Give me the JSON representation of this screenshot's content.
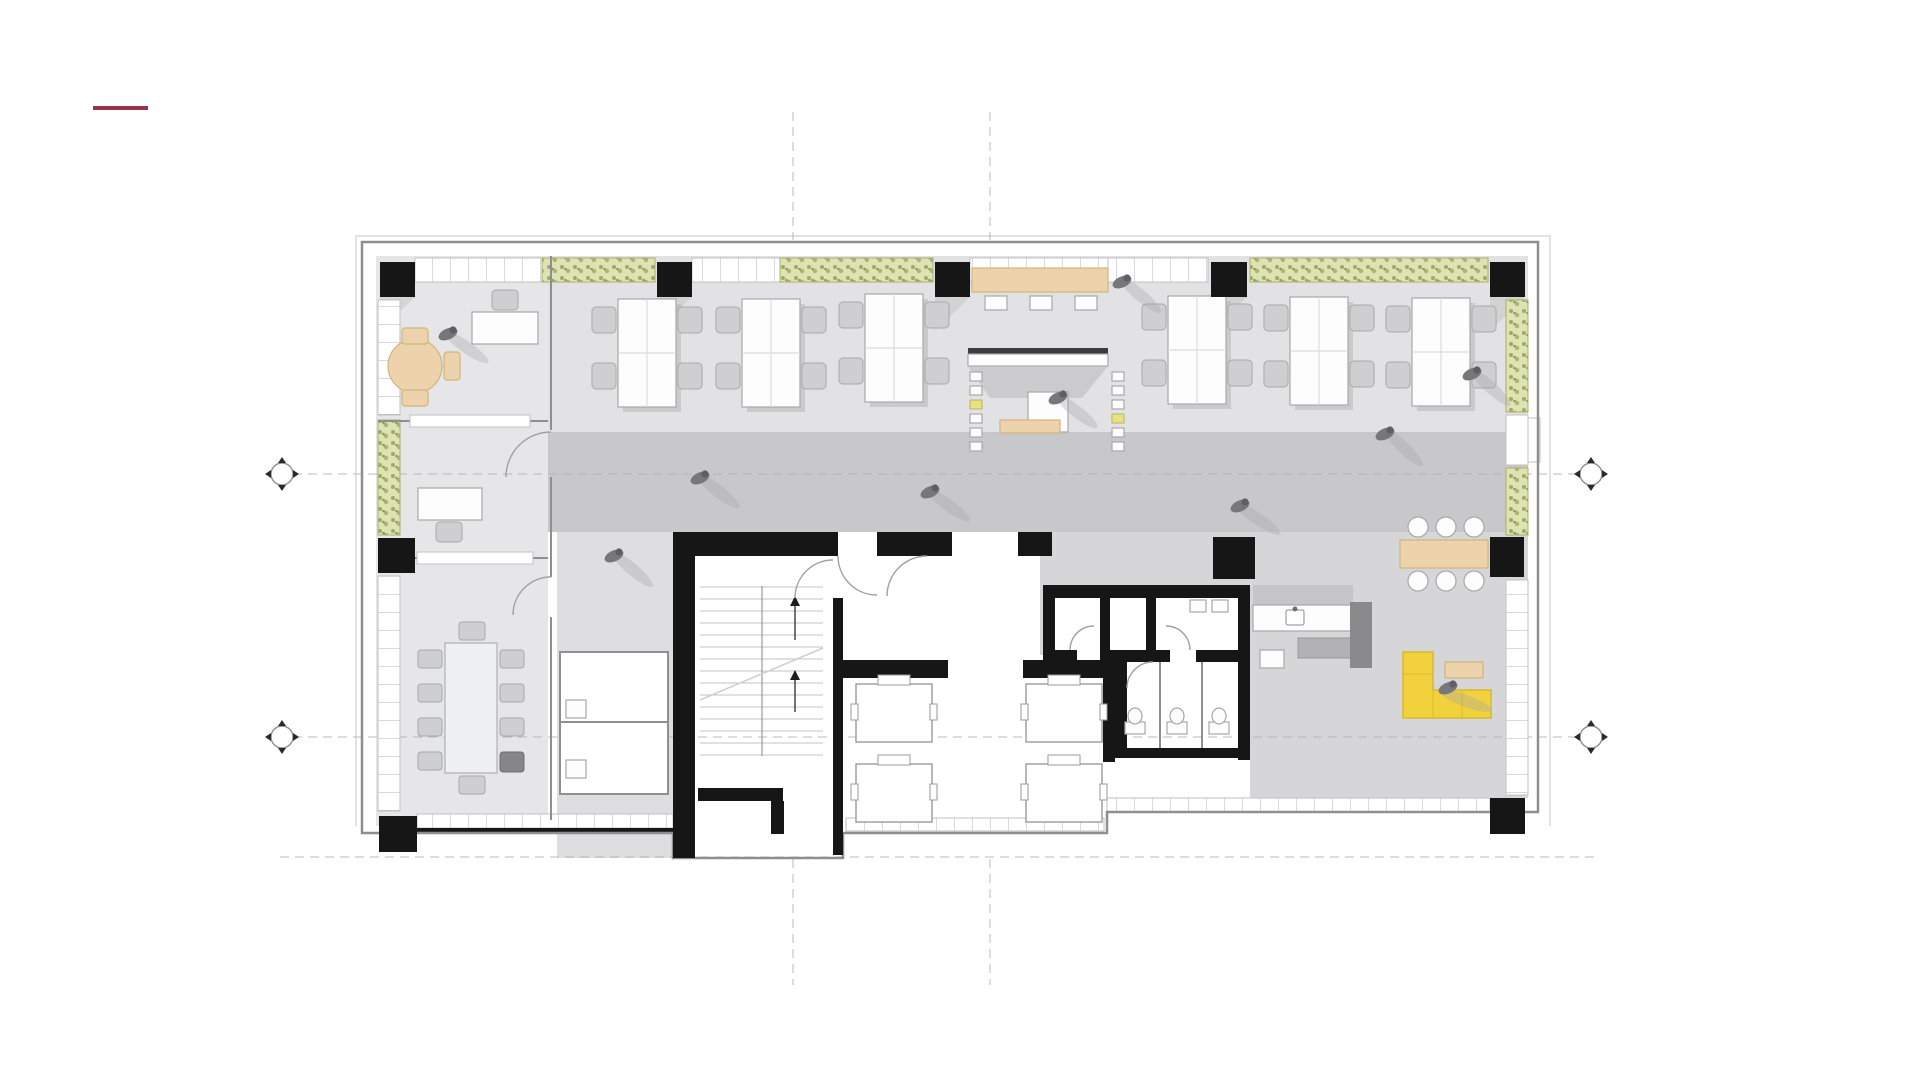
{
  "meta": {
    "label": "architectural-office-floor-plan-slide"
  },
  "accent_mark": {
    "color": "#993349",
    "x": 93,
    "y": 106,
    "width": 55,
    "height": 4
  },
  "palette": {
    "bg": "#ffffff",
    "floor": "#e2e2e4",
    "floor-office": "#e6e6e8",
    "floor-inner": "#dedee0",
    "corridor": "#c8c8cb",
    "lounge": "#d6d6d9",
    "wall": "#8f8f92",
    "wall-dark": "#161616",
    "window": "#ffffff",
    "mullion": "#c2c2c5",
    "planter": "#dde3b2",
    "planter-dot": "#8f9c52",
    "planter-edge": "#a8b06a",
    "wood": "#ecd3ab",
    "wood-edge": "#d3b37f",
    "sofa": "#f2d23c",
    "sofa-edge": "#d9b92e",
    "table": "#fdfdfd",
    "chair": "#cfcfd2",
    "furniture-stroke": "#a8a8ab",
    "person": "#77777b",
    "person-dark": "#5f5f63",
    "shadow": "#a7a7ab",
    "grid": "#b0b0b3",
    "arc": "#a0a0a3",
    "outline-light": "#d8d8da",
    "tread": "#c3c3c6"
  },
  "grid": {
    "h_segments": [
      [
        293,
        474,
        1580
      ],
      [
        293,
        737,
        1580
      ],
      [
        280,
        857,
        1600
      ]
    ],
    "v_segments": [
      [
        793,
        112,
        240
      ],
      [
        793,
        859,
        985
      ],
      [
        990,
        112,
        240
      ],
      [
        990,
        859,
        985
      ]
    ],
    "bubbles": [
      [
        282,
        474
      ],
      [
        282,
        737
      ],
      [
        1591,
        474
      ],
      [
        1591,
        737
      ]
    ]
  },
  "plan": {
    "columns": [
      [
        380,
        262,
        35,
        35,
        1
      ],
      [
        657,
        262,
        35,
        35,
        1
      ],
      [
        935,
        262,
        35,
        35,
        1
      ],
      [
        1211,
        262,
        36,
        35,
        1
      ],
      [
        1490,
        262,
        35,
        35,
        1
      ],
      [
        378,
        538,
        37,
        35,
        0
      ],
      [
        1490,
        537,
        34,
        40,
        0
      ],
      [
        379,
        816,
        38,
        36,
        0
      ],
      [
        1490,
        798,
        35,
        36,
        0
      ],
      [
        1213,
        537,
        42,
        42,
        0
      ],
      [
        1018,
        532,
        34,
        24,
        0
      ]
    ],
    "desk_clusters": [
      [
        618,
        299
      ],
      [
        742,
        299
      ],
      [
        865,
        294
      ],
      [
        1168,
        296
      ],
      [
        1290,
        297
      ],
      [
        1412,
        298
      ]
    ],
    "elevator_cabs": [
      [
        856,
        684
      ],
      [
        856,
        764
      ],
      [
        1026,
        684
      ],
      [
        1026,
        764
      ]
    ],
    "people": [
      [
        448,
        334,
        35
      ],
      [
        1122,
        282,
        40
      ],
      [
        1058,
        398,
        38
      ],
      [
        1472,
        374,
        42
      ],
      [
        614,
        556,
        40
      ],
      [
        930,
        492,
        36
      ],
      [
        1385,
        434,
        44
      ],
      [
        1240,
        506,
        34
      ],
      [
        1448,
        688,
        20
      ],
      [
        700,
        478,
        38
      ]
    ],
    "inventory": {
      "structural_columns": 11,
      "open_desk_clusters": 6,
      "conference_seats": 10,
      "elevators": 4,
      "stair_cores": 1,
      "wc_stalls": 3,
      "planter_strips": 6,
      "lounge_sofa_color": "yellow"
    }
  }
}
